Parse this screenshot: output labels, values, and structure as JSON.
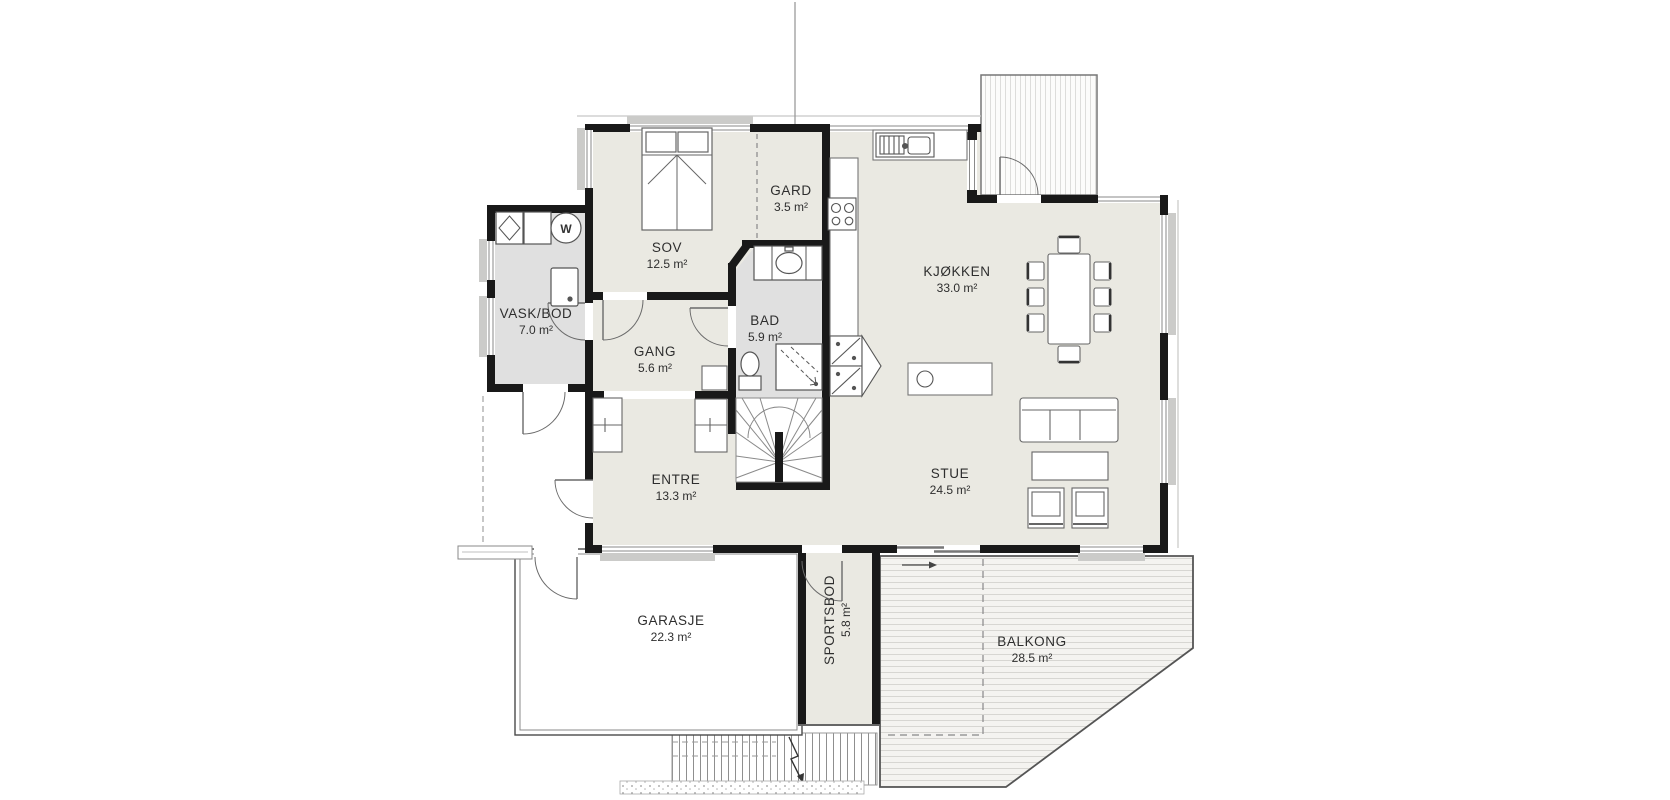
{
  "plan": {
    "type": "floorplan",
    "language": "Norwegian",
    "rooms": [
      {
        "name": "SOV",
        "area": "12.5 m²"
      },
      {
        "name": "GARD",
        "area": "3.5 m²"
      },
      {
        "name": "VASK/BOD",
        "area": "7.0 m²"
      },
      {
        "name": "BAD",
        "area": "5.9 m²"
      },
      {
        "name": "GANG",
        "area": "5.6 m²"
      },
      {
        "name": "ENTRE",
        "area": "13.3 m²"
      },
      {
        "name": "KJØKKEN",
        "area": "33.0 m²"
      },
      {
        "name": "STUE",
        "area": "24.5 m²"
      },
      {
        "name": "GARASJE",
        "area": "22.3 m²"
      },
      {
        "name": "SPORTSBOD",
        "area": "5.8 m²"
      },
      {
        "name": "BALKONG",
        "area": "28.5 m²"
      }
    ],
    "fixtures": {
      "washer_label": "W"
    },
    "colors": {
      "wall": "#191919",
      "floor": "#eae9e2",
      "wet_floor": "#e0e0e0",
      "deck_stripe": "#d7d6d2",
      "line": "#666666",
      "sill": "#cbcbc9"
    }
  }
}
